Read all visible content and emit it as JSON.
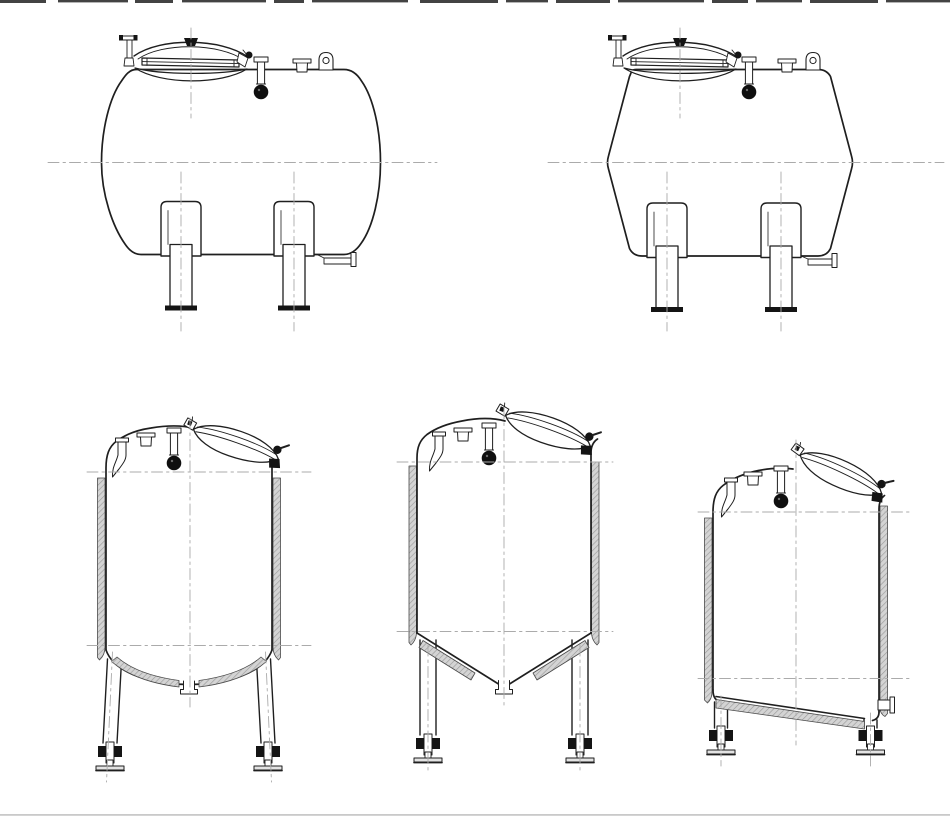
{
  "sheet": {
    "label": "Technical line drawings of five stainless steel process tanks",
    "background_color": "#ffffff",
    "line_color": "#1f1f1f",
    "centerline_color": "#ababab",
    "insulation_fill": "#d4d4d4",
    "insulation_hatch": "#9b9b9b",
    "hardware_color": "#141414"
  },
  "tanks": [
    {
      "id": "horizontal-tank-dished-ends",
      "label": "Horizontal tank with dished ends - side elevation",
      "position": "top-left",
      "features": [
        "oval manway with swing-bolt cover",
        "spray-ball nozzle",
        "stub nozzle",
        "lifting lug",
        "two saddle legs with base plates",
        "bottom drain outlet",
        "dash-dot centerlines"
      ]
    },
    {
      "id": "horizontal-tank-conical-ends",
      "label": "Horizontal tank with conical ends - side elevation",
      "position": "top-right",
      "features": [
        "oval manway with swing-bolt cover",
        "spray-ball nozzle",
        "stub nozzle",
        "lifting lug",
        "two saddle legs with base plates",
        "bottom drain outlet",
        "dash-dot centerlines"
      ]
    },
    {
      "id": "vertical-tank-dished-bottom",
      "label": "Vertical insulated tank with dished bottom",
      "position": "bottom-left",
      "features": [
        "tilted oval manway",
        "gooseneck vent",
        "spray-ball nozzle",
        "stub nozzle",
        "side insulation jacket",
        "insulated dished bottom",
        "two legs with adjustable feet",
        "centre bottom outlet"
      ]
    },
    {
      "id": "vertical-tank-conical-bottom",
      "label": "Vertical insulated tank with conical bottom",
      "position": "bottom-centre",
      "features": [
        "tilted oval manway",
        "gooseneck vent",
        "spray-ball nozzle",
        "stub nozzle",
        "side insulation jacket",
        "insulated conical bottom",
        "two legs with adjustable feet",
        "apex bottom outlet"
      ]
    },
    {
      "id": "vertical-tank-sloped-bottom",
      "label": "Vertical insulated tank with sloped flat bottom",
      "position": "bottom-right",
      "features": [
        "tilted oval manway",
        "gooseneck vent",
        "spray-ball nozzle",
        "stub nozzle",
        "side insulation jacket",
        "insulated sloped bottom",
        "side bottom outlet",
        "two legs with adjustable feet"
      ]
    }
  ],
  "edge_artifacts": {
    "top": "dark cropped dash marks along top edge",
    "bottom": "faint grey rule along bottom edge"
  }
}
